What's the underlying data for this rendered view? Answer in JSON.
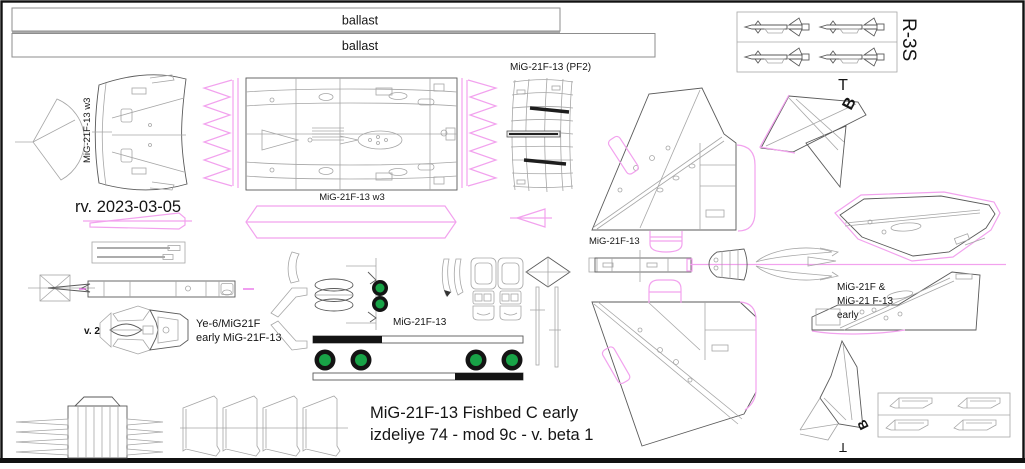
{
  "sheet": {
    "title_line1": "MiG-21F-13 Fishbed C early",
    "title_line2": "izdeliye 74 - mod 9c - v. beta 1",
    "revision": "rv. 2023-03-05"
  },
  "labels": {
    "ballast_top": "ballast",
    "ballast_bottom": "ballast",
    "left_skin": "MiG-21F-13 w3",
    "center_skin": "MiG-21F-13 w3",
    "pf2_panel": "MiG-21F-13 (PF2)",
    "wing_panel": "MiG-21F-13",
    "gear_assembly": "MiG-21F-13",
    "missiles": "R-3S",
    "marker_t_top": "T",
    "marker_b_top": "B",
    "marker_b_bottom": "B",
    "marker_t_bottom": "T",
    "fin_line1": "MiG-21F &",
    "fin_line2": "MiG-21 F-13",
    "fin_line3": "early",
    "cockpit_version": "v. 2",
    "cockpit_line1": "Ye-6/MiG21F",
    "cockpit_line2": "early MiG-21F-13"
  },
  "colors": {
    "outline": "#5a5a5a",
    "detail": "#a6a6a6",
    "magenta": "#f2a2ee",
    "magenta_strong": "#e86ae8",
    "wheel_green": "#18a347",
    "black": "#141414"
  }
}
